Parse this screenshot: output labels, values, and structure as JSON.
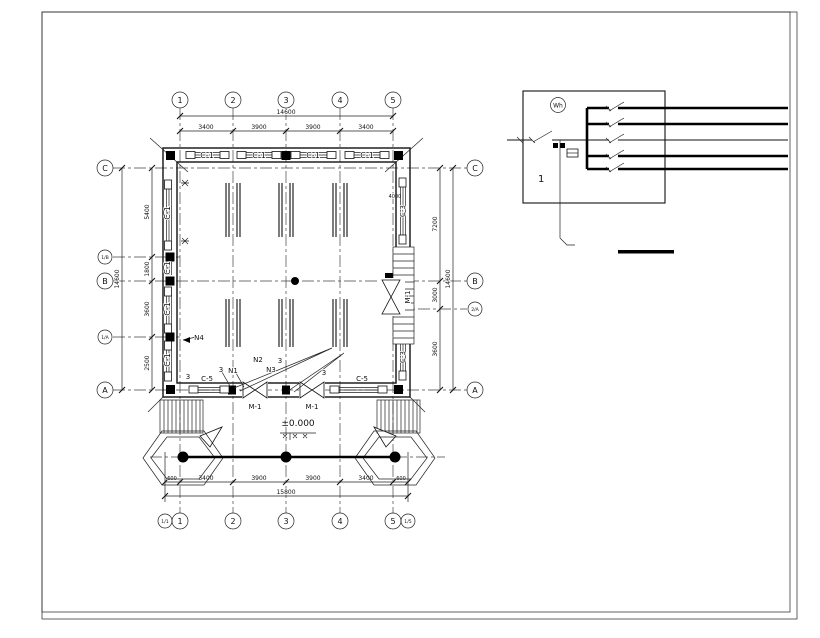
{
  "colors": {
    "line": "#000000",
    "background": "#ffffff"
  },
  "plan": {
    "axes": {
      "top": [
        "1",
        "2",
        "3",
        "4",
        "5"
      ],
      "bottom": [
        "1/1",
        "1",
        "2",
        "3",
        "4",
        "5",
        "1/5"
      ],
      "left": [
        "C",
        "1/B",
        "B",
        "1/A",
        "A"
      ],
      "right": [
        "C",
        "B",
        "2/A",
        "A"
      ]
    },
    "dims": {
      "top_segments": [
        "3400",
        "3900",
        "3900",
        "3400"
      ],
      "top_total": "14600",
      "bottom_segments": [
        "600",
        "3400",
        "3900",
        "3900",
        "3400",
        "600"
      ],
      "bottom_total": "15800",
      "left_segments": [
        "5400",
        "1800",
        "3600",
        "2500"
      ],
      "left_total": "14600",
      "right_segments": [
        "7200",
        "3000",
        "3600"
      ],
      "right_total": "14600",
      "stair_note": "4000"
    },
    "labels": {
      "c1": "C-1",
      "c3": "C-3",
      "c5": "C-5",
      "m1": "M-1",
      "n1": "N1",
      "n2": "N2",
      "n3": "N3",
      "n4": "N4",
      "mark3": "3",
      "elevation": "±0.000"
    }
  },
  "schematic": {
    "meter_label": "Wh",
    "panel_label": "1"
  }
}
